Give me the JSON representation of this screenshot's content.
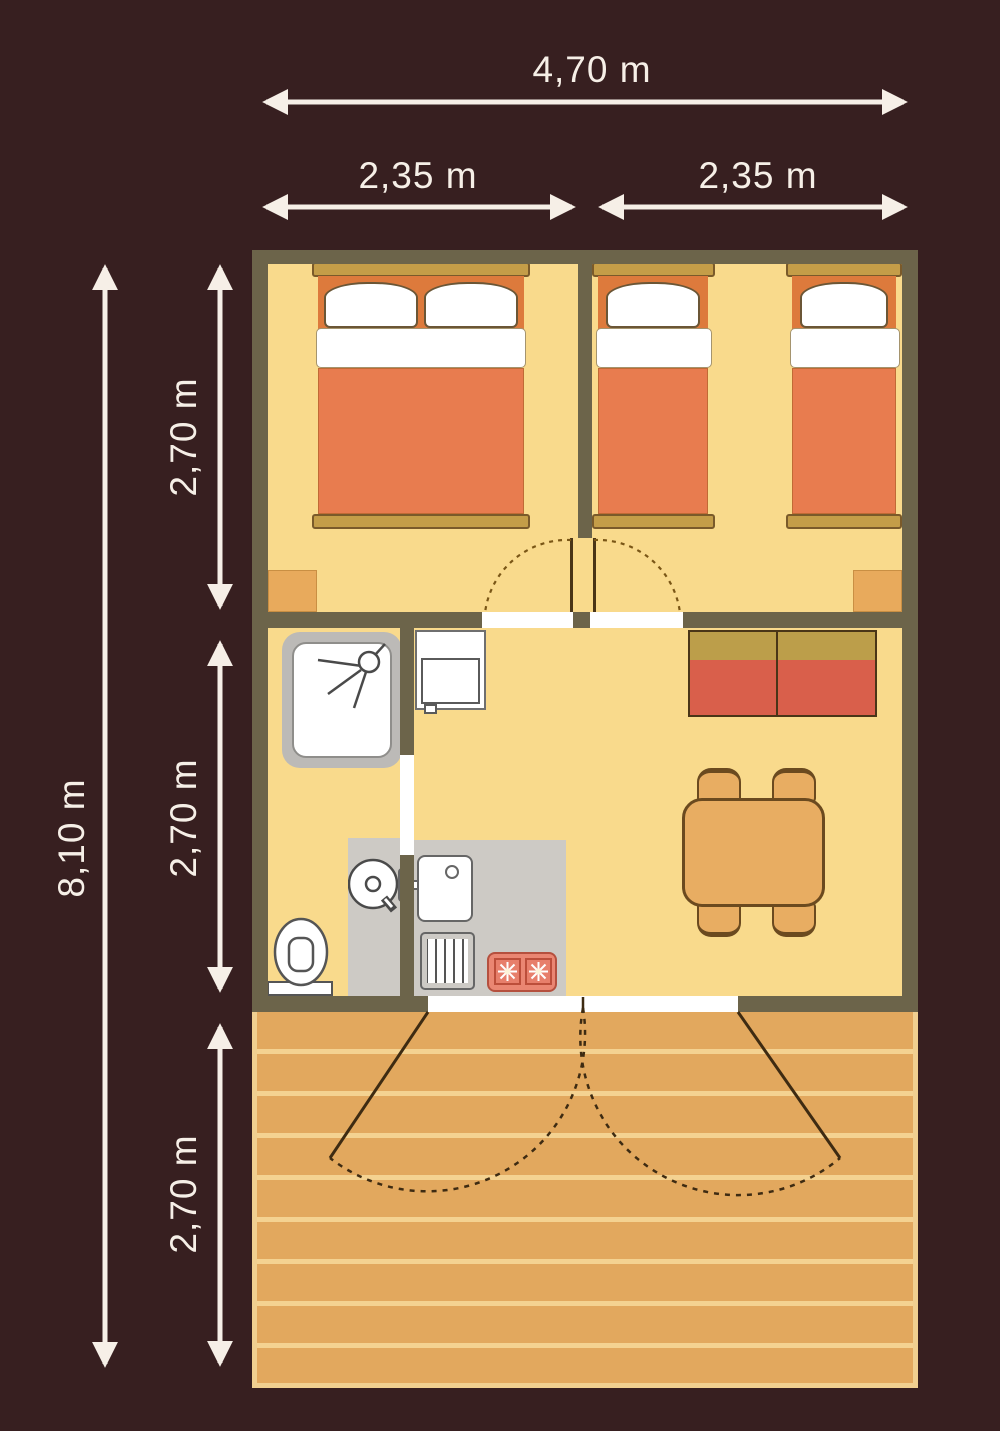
{
  "dimensions": {
    "overall_width": "4,70 m",
    "bedroom1_width": "2,35 m",
    "bedroom2_width": "2,35 m",
    "overall_depth": "8,10 m",
    "bedrooms_depth": "2,70 m",
    "living_depth": "2,70 m",
    "terrace_depth": "2,70 m"
  },
  "colors": {
    "background": "#371f20",
    "wall": "#6c644a",
    "floor": "#f9da8c",
    "bed_blanket": "#e87c4f",
    "bed_headboard_zone": "#dd7a3c",
    "bed_frame_bar": "#c49d48",
    "sofa_back": "#bc9e4a",
    "sofa_seat": "#d95f4b",
    "table_and_chairs": "#e8ad62",
    "wardrobe": "#e8aa5c",
    "deck_plank": "#e2a85e",
    "deck_gap": "#f4d291",
    "appliance_gray": "#cdcac5",
    "stove": "#ea8672",
    "dimension_text_and_arrows": "#f6efe7"
  },
  "icons": {
    "shower": "shower-spray-icon",
    "washer": "washing-machine-icon",
    "toilet": "toilet-icon",
    "stove": "gas-burner-icon"
  }
}
